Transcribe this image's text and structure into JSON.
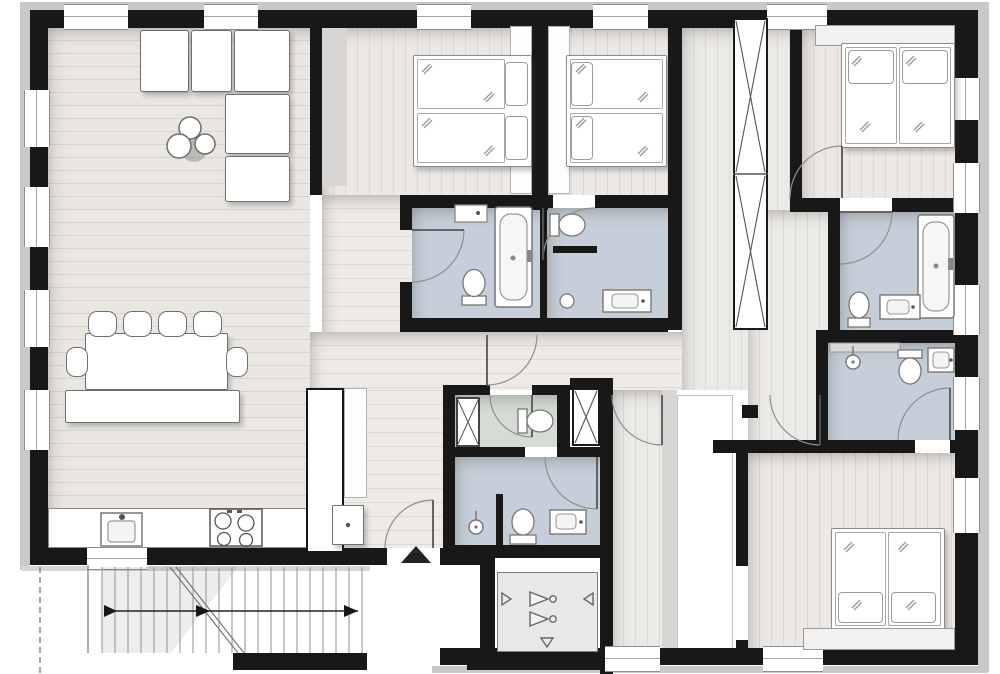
{
  "title": "apartment-floor-plan",
  "palette": {
    "wall": "#181818",
    "facade_lining": "#c9c9c9",
    "wood_floor": "#eae7e3",
    "bedroom_floor": "#ece8e5",
    "bathroom_floor": "#c6cfd9",
    "wc_floor": "#d5dcd4",
    "furniture_fill": "#ffffff",
    "furniture_stroke": "#6e6e6e",
    "door_arc": "#8f8f8f",
    "symbol": "#555555"
  },
  "rooms": [
    {
      "id": "living-dining-kitchen",
      "floor": "wood",
      "furniture": [
        "l-shaped-sofa",
        "coffee-tables-3",
        "dining-table",
        "chairs-6",
        "bench",
        "kitchen-counter",
        "sink",
        "cooktop-4-burners",
        "tall-cabinet"
      ]
    },
    {
      "id": "bedroom-1",
      "floor": "wood",
      "furniture": [
        "double-bed-2-mattresses",
        "wardrobe-column"
      ]
    },
    {
      "id": "bedroom-2",
      "floor": "wood",
      "furniture": [
        "double-bed-2-mattresses",
        "wardrobe-column"
      ]
    },
    {
      "id": "bedroom-3",
      "floor": "wood",
      "furniture": [
        "double-bed-2-mattresses",
        "headboard"
      ]
    },
    {
      "id": "bedroom-4",
      "floor": "wood",
      "furniture": [
        "double-bed-2-mattresses",
        "headboard"
      ]
    },
    {
      "id": "bathroom-a",
      "floor": "tile",
      "fixtures": [
        "bathtub",
        "toilet",
        "shelf"
      ]
    },
    {
      "id": "bathroom-b",
      "floor": "tile",
      "fixtures": [
        "toilet",
        "vanity-sink",
        "pedestal"
      ]
    },
    {
      "id": "bathroom-c",
      "floor": "tile",
      "fixtures": [
        "bathtub",
        "toilet",
        "vanity-sink"
      ]
    },
    {
      "id": "bathroom-d",
      "floor": "tile",
      "fixtures": [
        "shower",
        "toilet",
        "sink",
        "shelf"
      ]
    },
    {
      "id": "bathroom-e",
      "floor": "tile",
      "fixtures": [
        "shower",
        "toilet",
        "sink",
        "partition"
      ]
    },
    {
      "id": "wc-laundry",
      "floor": "tile",
      "fixtures": [
        "washing-machine",
        "toilet"
      ]
    },
    {
      "id": "hallway",
      "floor": "wood",
      "fixtures": []
    },
    {
      "id": "elevator",
      "fixtures": [
        "elevator-symbol"
      ]
    },
    {
      "id": "staircase",
      "fixtures": [
        "treads",
        "walk-line-arrow",
        "break-line"
      ]
    }
  ],
  "shafts": 2,
  "windows": {
    "top": 5,
    "left": 4,
    "right": 5,
    "bottom": 2,
    "kitchen": 1
  },
  "entrance": {
    "marker": "up-triangle",
    "location": "bottom-center"
  },
  "icons": [
    "elevator-arrows-icon",
    "stair-direction-arrow-icon",
    "duct-cross-icon",
    "entrance-triangle-icon"
  ]
}
